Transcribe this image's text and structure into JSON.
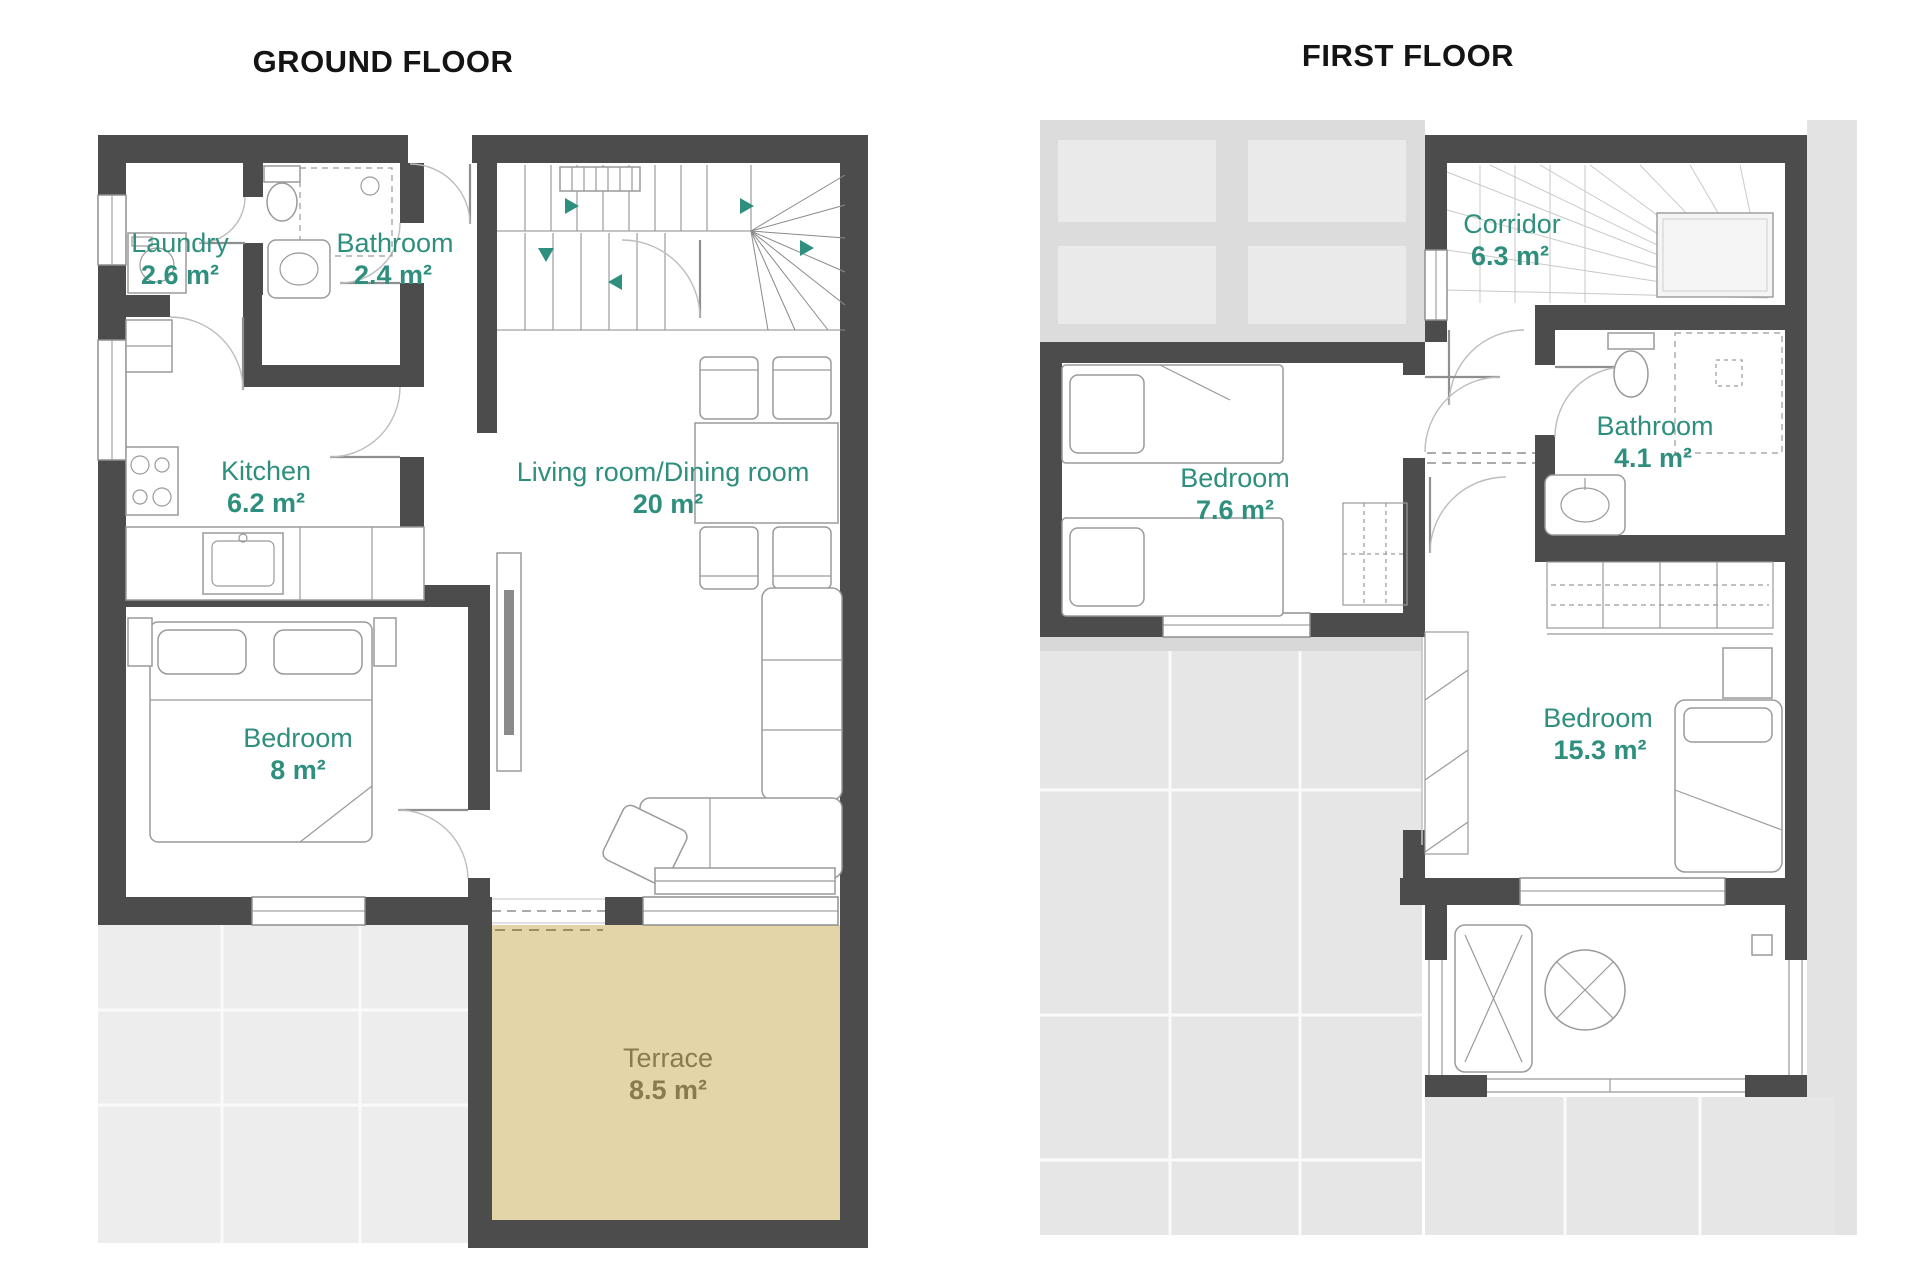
{
  "colors": {
    "wall": "#4c4c4c",
    "room_label": "#2f8f7e",
    "terrace_fill": "#e4d5a9",
    "terrace_label": "#8c7a4f",
    "paving_gray": "#ededed",
    "footprint_gray": "#dcdcdc",
    "title_black": "#141414"
  },
  "floors": [
    {
      "id": "ground-floor",
      "title": "GROUND FLOOR",
      "rooms": [
        {
          "name": "Laundry",
          "area": "2.6 m²"
        },
        {
          "name": "Bathroom",
          "area": "2.4 m²"
        },
        {
          "name": "Kitchen",
          "area": "6.2 m²"
        },
        {
          "name": "Living room/Dining room",
          "area": "20 m²"
        },
        {
          "name": "Bedroom",
          "area": "8 m²"
        },
        {
          "name": "Terrace",
          "area": "8.5 m²"
        }
      ]
    },
    {
      "id": "first-floor",
      "title": "FIRST FLOOR",
      "rooms": [
        {
          "name": "Corridor",
          "area": "6.3 m²"
        },
        {
          "name": "Bedroom",
          "area": "7.6 m²"
        },
        {
          "name": "Bathroom",
          "area": "4.1 m²"
        },
        {
          "name": "Bedroom",
          "area": "15.3 m²"
        }
      ]
    }
  ]
}
